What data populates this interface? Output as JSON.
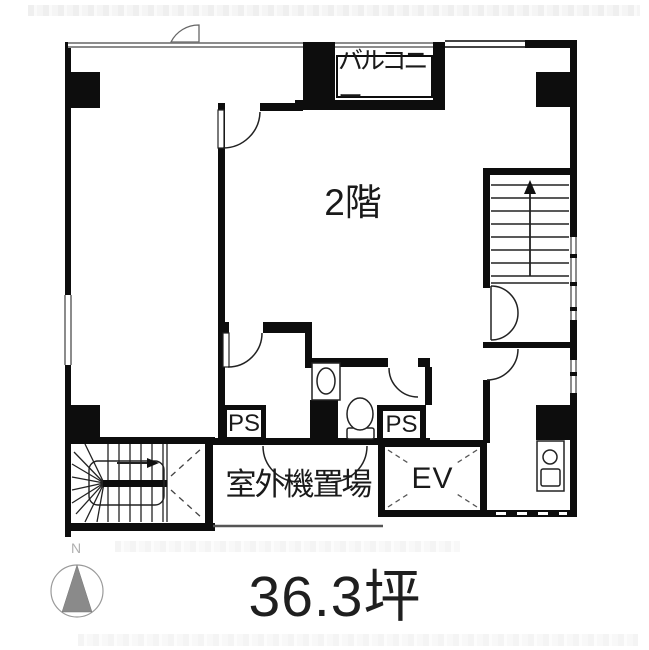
{
  "floor_plan": {
    "floor_label": "2階",
    "balcony_label": "バルコニー",
    "ps_left_label": "PS",
    "ps_right_label": "PS",
    "outdoor_unit_label": "室外機置場",
    "elevator_label": "EV",
    "area_label": "36.3坪",
    "compass_north_label": "N",
    "colors": {
      "wall": "#0d0d0d",
      "text": "#1a1a1a",
      "window_gray": "#8c8c8c",
      "compass_arrow": "#8a8a8a",
      "background": "#ffffff"
    }
  }
}
